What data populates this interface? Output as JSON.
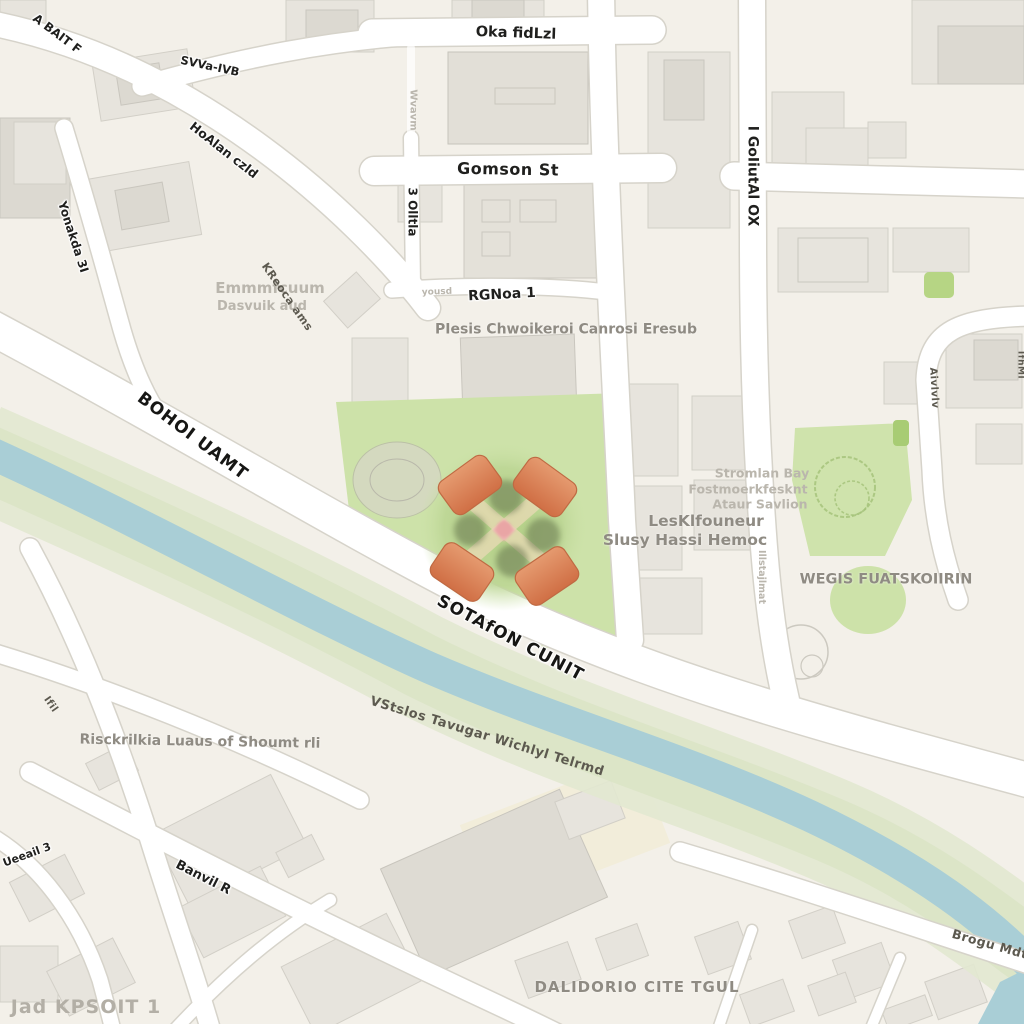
{
  "map": {
    "title": "city-map-with-central-monument-park",
    "colors": {
      "background": "#f3f0e9",
      "road_fill": "#ffffff",
      "road_casing": "#d6d3ca",
      "building": "#e7e4dd",
      "building_dark": "#dcd9d1",
      "park_green": "#cde2a9",
      "park_circle": "#b4d187",
      "river_teal": "#a9ced6",
      "greenway": "#dde6c8",
      "monument_orange": "#d97a4f",
      "monument_center_pink": "#e9a5a5",
      "street_label": "#1f1f1d",
      "place_label": "#8f8b83",
      "watermark_label": "#b3afa6"
    },
    "labels": [
      {
        "name": "street-label-a-bait",
        "text": "A BAIT F",
        "cls": "street",
        "x": 57,
        "y": 34,
        "rot": 37,
        "size": 12
      },
      {
        "name": "street-label-svva-ivb",
        "text": "SVVa-IVB",
        "cls": "street",
        "x": 210,
        "y": 66,
        "rot": 12,
        "size": 11.5
      },
      {
        "name": "street-label-hoalan-czld",
        "text": "HoAlan czld",
        "cls": "street",
        "x": 224,
        "y": 150,
        "rot": 38,
        "size": 12.5
      },
      {
        "name": "street-label-yonakda",
        "text": "Yonakda 3I",
        "cls": "street",
        "x": 73,
        "y": 237,
        "rot": 72,
        "size": 12
      },
      {
        "name": "street-label-oka-fidlzl",
        "text": "Oka fidLzl",
        "cls": "street",
        "x": 516,
        "y": 34,
        "rot": 2,
        "size": 14.5
      },
      {
        "name": "street-label-gomson-st",
        "text": "Gomson St",
        "cls": "street",
        "x": 508,
        "y": 170,
        "rot": 1,
        "size": 16,
        "ls": 0.5
      },
      {
        "name": "street-label-olllta",
        "text": "3 Olltla",
        "cls": "street",
        "x": 412,
        "y": 212,
        "rot": 90,
        "size": 12
      },
      {
        "name": "street-label-wvavm",
        "text": "Wvavm",
        "cls": "faint",
        "x": 412,
        "y": 110,
        "rot": 90,
        "size": 10
      },
      {
        "name": "street-label-i-goliutal",
        "text": "I GoIiutAl OX",
        "cls": "street",
        "x": 752,
        "y": 176,
        "rot": 90,
        "size": 14
      },
      {
        "name": "street-label-rgnoa",
        "text": "RGNoa 1",
        "cls": "street",
        "x": 502,
        "y": 295,
        "rot": -3,
        "size": 14
      },
      {
        "name": "street-label-yousd",
        "text": "yousd",
        "cls": "faint",
        "x": 437,
        "y": 293,
        "rot": -2,
        "size": 9
      },
      {
        "name": "place-label-plesis",
        "text": "PIesis Chwoikeroi Canrosi Eresub",
        "cls": "place",
        "x": 566,
        "y": 330,
        "rot": 0,
        "size": 14
      },
      {
        "name": "place-label-emmm-1",
        "text": "Emmmfcuum",
        "cls": "faint",
        "x": 270,
        "y": 289,
        "rot": 0,
        "size": 15
      },
      {
        "name": "place-label-emmm-2",
        "text": "Dasvuik aud",
        "cls": "faint",
        "x": 262,
        "y": 307,
        "rot": 0,
        "size": 13
      },
      {
        "name": "street-label-kreoca",
        "text": "KReoca ams",
        "cls": "water",
        "x": 287,
        "y": 297,
        "rot": 55,
        "size": 11
      },
      {
        "name": "street-label-bohoi-uamt",
        "text": "BOHOI UAMT",
        "cls": "major",
        "x": 192,
        "y": 437,
        "rot": 37,
        "size": 17,
        "ls": 1
      },
      {
        "name": "street-label-sotafon",
        "text": "SOTAfON CUNIT",
        "cls": "major",
        "x": 510,
        "y": 639,
        "rot": 28,
        "size": 17,
        "ls": 1
      },
      {
        "name": "place-label-stromlan-1",
        "text": "Stromlan Bay",
        "cls": "faint",
        "x": 762,
        "y": 473,
        "rot": 0,
        "size": 12.5
      },
      {
        "name": "place-label-stromlan-2",
        "text": "Fostmoerkfesknt",
        "cls": "faint",
        "x": 748,
        "y": 489,
        "rot": 0,
        "size": 12.5
      },
      {
        "name": "place-label-stromlan-3",
        "text": "Ataur Savlion",
        "cls": "faint",
        "x": 760,
        "y": 504,
        "rot": 0,
        "size": 12.5
      },
      {
        "name": "place-label-lesklfouneur",
        "text": "LesKlfouneur",
        "cls": "place",
        "x": 706,
        "y": 521,
        "rot": 0,
        "size": 15.5
      },
      {
        "name": "place-label-slusy",
        "text": "Slusy Hassi Hemoc",
        "cls": "place",
        "x": 685,
        "y": 540,
        "rot": 0,
        "size": 15.5
      },
      {
        "name": "place-label-wegis",
        "text": "WEGIS FUATSKOIIRIN",
        "cls": "place",
        "x": 886,
        "y": 580,
        "rot": 0,
        "size": 14.5
      },
      {
        "name": "street-label-illstajlmat",
        "text": "Illstajlmat",
        "cls": "faint",
        "x": 761,
        "y": 577,
        "rot": 90,
        "size": 9.5
      },
      {
        "name": "street-label-aivlvlv",
        "text": "Aivlvlv",
        "cls": "water",
        "x": 933,
        "y": 388,
        "rot": 87,
        "size": 10
      },
      {
        "name": "street-label-ifhml",
        "text": "IfhMl",
        "cls": "water",
        "x": 1020,
        "y": 365,
        "rot": 90,
        "size": 9
      },
      {
        "name": "water-label-vstslos",
        "text": "VStslos Tavugar Wichlyl Telrmd",
        "cls": "water",
        "x": 487,
        "y": 737,
        "rot": 17,
        "size": 13
      },
      {
        "name": "place-label-risckrilkia",
        "text": "Risckrilkia Luaus of Shoumt rli",
        "cls": "place",
        "x": 200,
        "y": 742,
        "rot": 1,
        "size": 14
      },
      {
        "name": "street-label-ifil",
        "text": "Ifil",
        "cls": "water",
        "x": 50,
        "y": 705,
        "rot": 55,
        "size": 10
      },
      {
        "name": "street-label-ueeail",
        "text": "Ueeail 3",
        "cls": "street",
        "x": 27,
        "y": 855,
        "rot": -20,
        "size": 11
      },
      {
        "name": "street-label-banvil",
        "text": "Banvil R",
        "cls": "street",
        "x": 203,
        "y": 878,
        "rot": 27,
        "size": 13
      },
      {
        "name": "place-label-jad-kpsoit",
        "text": "Jad KPSOIT 1",
        "cls": "watermark",
        "x": 86,
        "y": 1008,
        "rot": 0,
        "size": 19,
        "ls": 1
      },
      {
        "name": "place-label-dalidorio",
        "text": "DALIDORIO CITE TGUL",
        "cls": "place",
        "x": 637,
        "y": 988,
        "rot": 0,
        "size": 15,
        "ls": 1
      },
      {
        "name": "street-label-brogu",
        "text": "Brogu Mdt",
        "cls": "water",
        "x": 990,
        "y": 944,
        "rot": 16,
        "size": 12.5
      }
    ]
  }
}
